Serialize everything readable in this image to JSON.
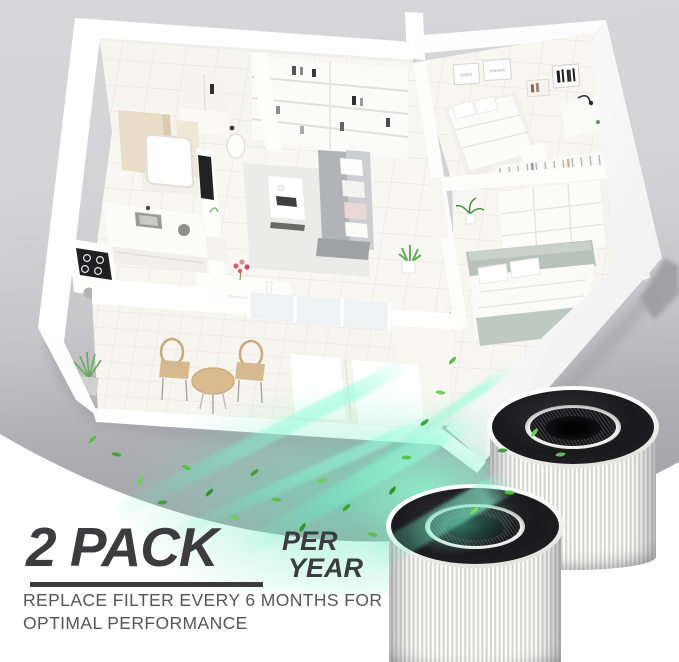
{
  "promo": {
    "headline": "2 PACK",
    "per_line1": "PER",
    "per_line2": "YEAR",
    "sub_line1": "REPLACE FILTER EVERY 6 MONTHS FOR",
    "sub_line2": "OPTIMAL PERFORMANCE",
    "text_color": "#3c3c3e"
  },
  "floorplan": {
    "wall_frame_left": "SWEET",
    "wall_frame_right": "DREAMS",
    "wall_color": "#ffffff",
    "floor_color": "#f7f6f1",
    "sofa_color": "#b2b3b7",
    "bed_blanket_color": "#b7c2ba",
    "wood_color": "#d9bb8e"
  },
  "filters": {
    "count": 2,
    "body_color": "#ffffff",
    "cap_color": "#1d1d1f",
    "glow_color": "#6fe8c0",
    "leaf_color": "#46b13c"
  },
  "background": {
    "backdrop_top": "#d7d7da",
    "ground": "#a8a8ac",
    "foreground": "#ffffff"
  }
}
